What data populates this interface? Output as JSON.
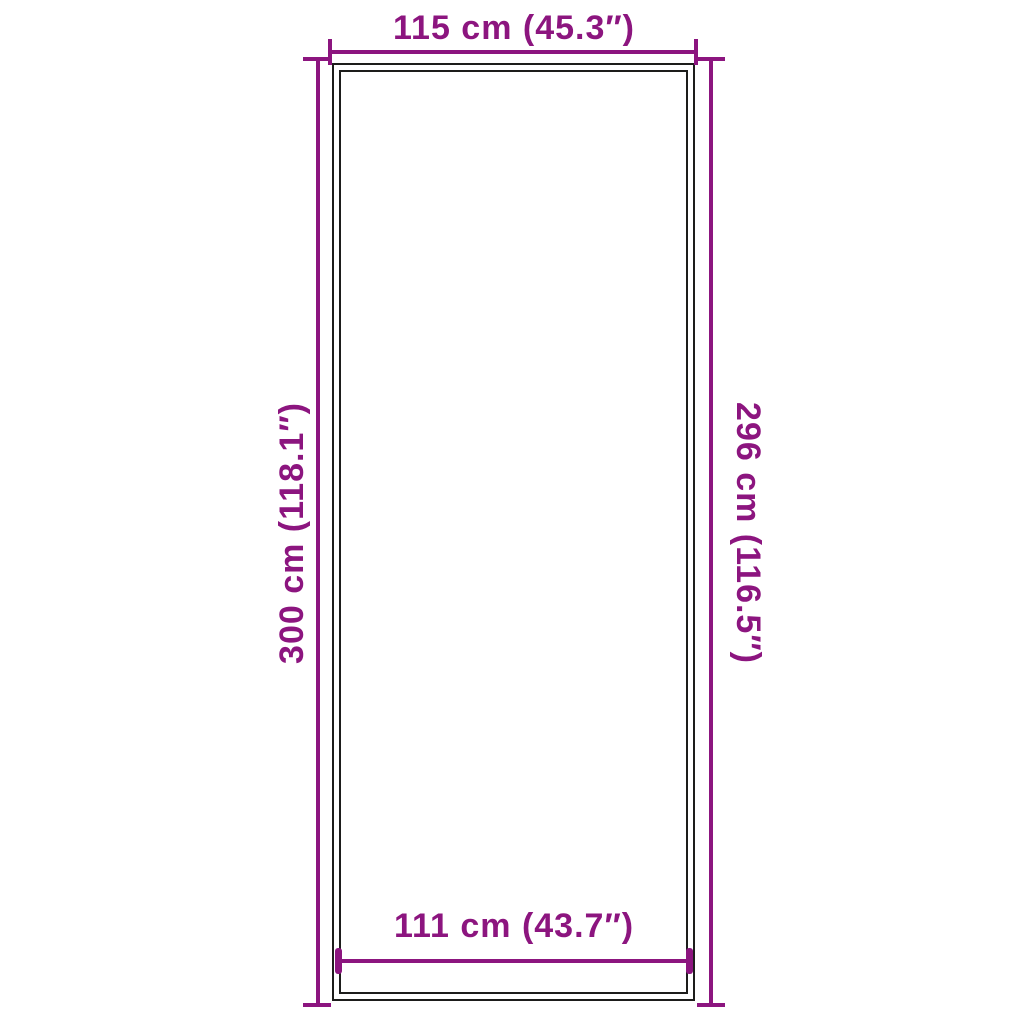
{
  "colors": {
    "dimension_accent": "#8C157F",
    "outline": "#1D1D1B",
    "background": "#FFFFFF"
  },
  "diagram": {
    "kind": "product-dimension-diagram",
    "shape": "rectangle-double-outline",
    "dimensions": {
      "top": {
        "label": "115 cm (45.3″)"
      },
      "bottom": {
        "label": "111 cm (43.7″)"
      },
      "left": {
        "label": "300 cm (118.1″)"
      },
      "right": {
        "label": "296 cm (116.5″)"
      }
    }
  }
}
